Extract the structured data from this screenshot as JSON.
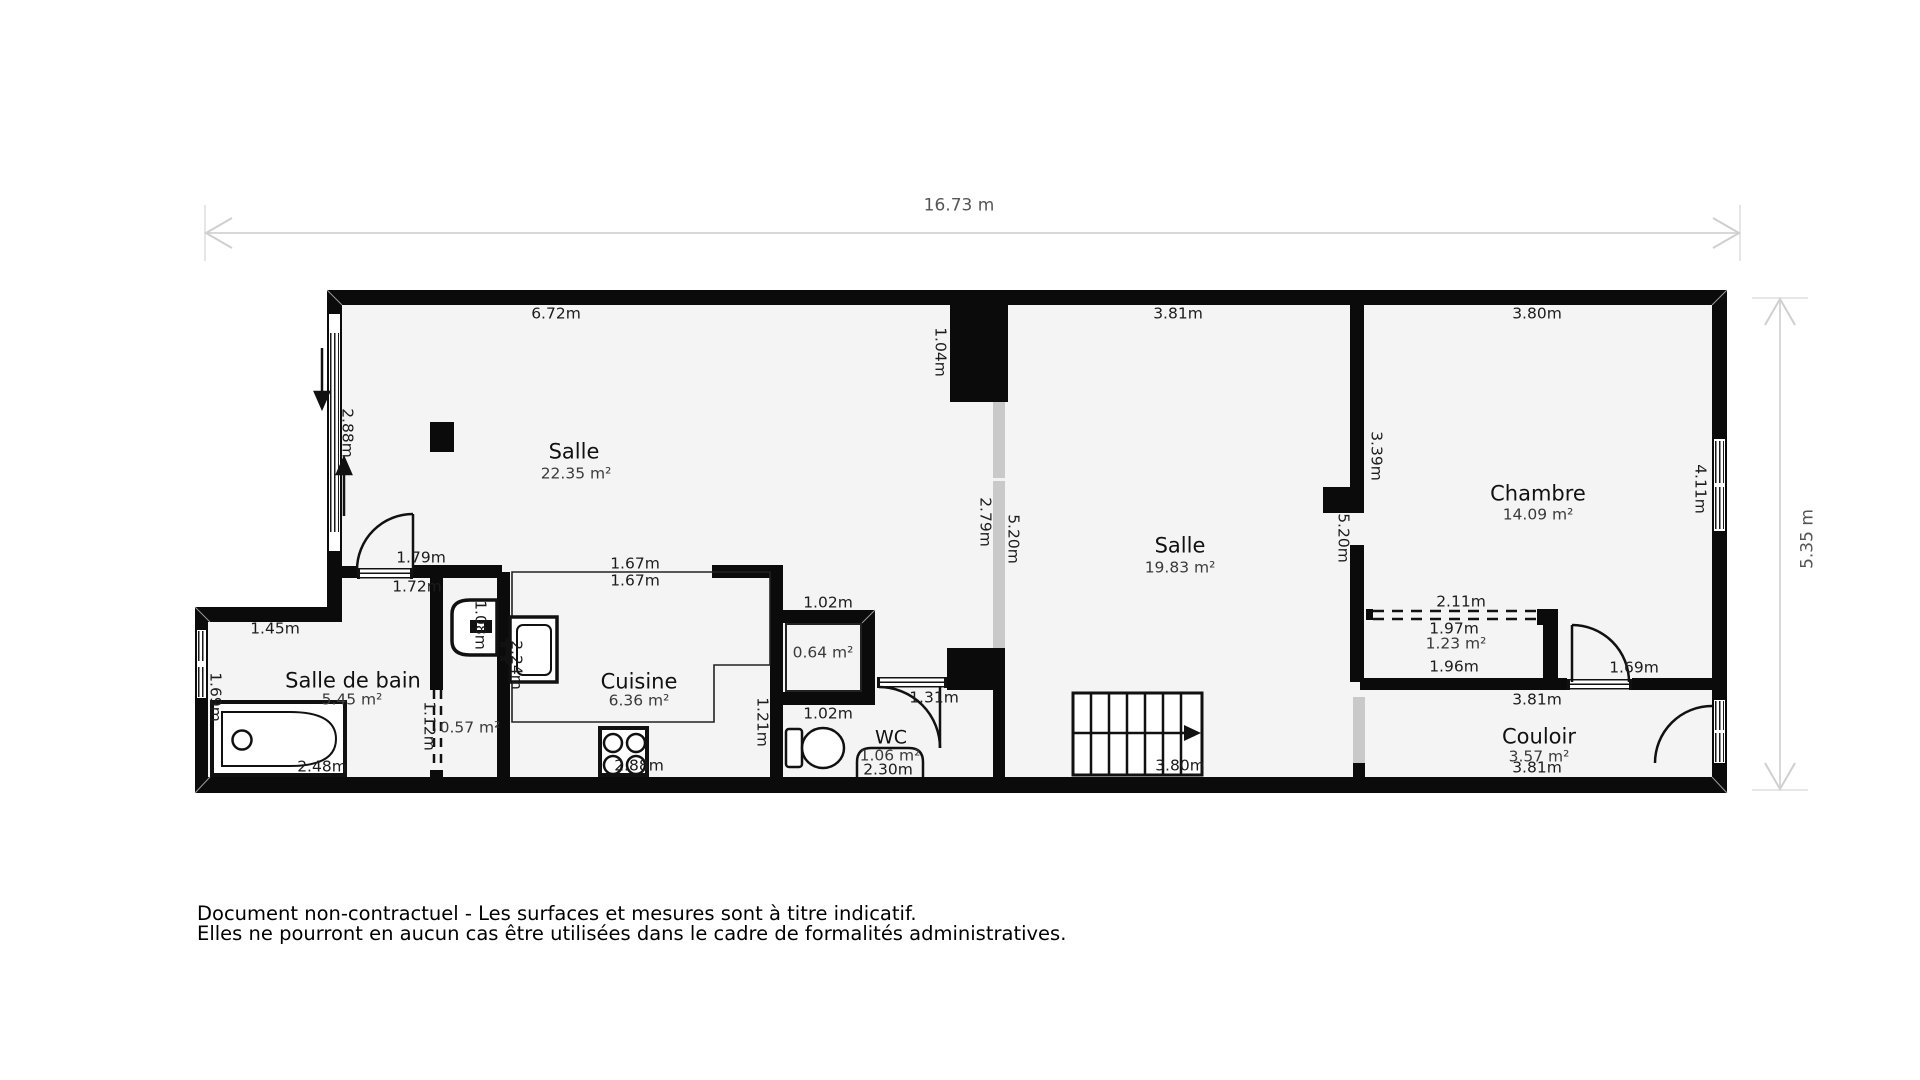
{
  "document": {
    "type": "floor-plan",
    "disclaimer_line1": "Document non-contractuel - Les surfaces et mesures sont à titre indicatif.",
    "disclaimer_line2": "Elles ne pourront en aucun cas être utilisées dans le cadre de formalités administratives.",
    "total_width": "16.73 m",
    "total_height": "5.35 m"
  },
  "rooms": [
    {
      "name": "Salle",
      "area": "22.35 m²"
    },
    {
      "name": "Salle",
      "area": "19.83 m²"
    },
    {
      "name": "Chambre",
      "area": "14.09 m²"
    },
    {
      "name": "Salle de bain",
      "area": "5.45 m²"
    },
    {
      "name": "Cuisine",
      "area": "6.36 m²"
    },
    {
      "name": "WC",
      "area": "1.06 m²"
    },
    {
      "name": "Couloir",
      "area": "3.57 m²"
    },
    {
      "name": "placard-chambre",
      "area": "1.23 m²"
    },
    {
      "name": "placard-cuisine",
      "area": "0.64 m²"
    },
    {
      "name": "placard-sdb",
      "area": "0.57 m²"
    }
  ],
  "labels": [
    {
      "name": "dim-total-width",
      "text": "16.73 m",
      "x": 959,
      "y": 206,
      "cls": "dim-total"
    },
    {
      "name": "dim-total-height",
      "text": "5.35 m",
      "x": 1808,
      "y": 539,
      "cls": "dim-total rot"
    },
    {
      "name": "dim-salle1-top",
      "text": "6.72m",
      "x": 556,
      "y": 314,
      "cls": "dim"
    },
    {
      "name": "dim-salle2-top",
      "text": "3.81m",
      "x": 1178,
      "y": 314,
      "cls": "dim"
    },
    {
      "name": "dim-chambre-top",
      "text": "3.80m",
      "x": 1537,
      "y": 314,
      "cls": "dim"
    },
    {
      "name": "room-salle1-name",
      "text": "Salle",
      "x": 574,
      "y": 452,
      "cls": "room-name"
    },
    {
      "name": "room-salle1-area",
      "text": "22.35 m²",
      "x": 576,
      "y": 474,
      "cls": "room-area"
    },
    {
      "name": "dim-pillar",
      "text": "1.04m",
      "x": 940,
      "y": 352,
      "cls": "dim dim-v"
    },
    {
      "name": "dim-salle1-window",
      "text": "2.88m",
      "x": 347,
      "y": 433,
      "cls": "dim dim-v"
    },
    {
      "name": "dim-chambre-left",
      "text": "3.39m",
      "x": 1376,
      "y": 456,
      "cls": "dim dim-v"
    },
    {
      "name": "dim-chambre-right",
      "text": "4.11m",
      "x": 1700,
      "y": 489,
      "cls": "dim dim-v"
    },
    {
      "name": "dim-glazing",
      "text": "2.79m",
      "x": 985,
      "y": 522,
      "cls": "dim dim-v"
    },
    {
      "name": "dim-salle2-left",
      "text": "5.20m",
      "x": 1013,
      "y": 539,
      "cls": "dim dim-v"
    },
    {
      "name": "dim-salle2-right",
      "text": "5.20m",
      "x": 1343,
      "y": 538,
      "cls": "dim dim-v"
    },
    {
      "name": "room-salle2-name",
      "text": "Salle",
      "x": 1180,
      "y": 546,
      "cls": "room-name"
    },
    {
      "name": "room-salle2-area",
      "text": "19.83 m²",
      "x": 1180,
      "y": 568,
      "cls": "room-area"
    },
    {
      "name": "room-chambre-name",
      "text": "Chambre",
      "x": 1538,
      "y": 494,
      "cls": "room-name"
    },
    {
      "name": "room-chambre-area",
      "text": "14.09 m²",
      "x": 1538,
      "y": 515,
      "cls": "room-area"
    },
    {
      "name": "dim-door-entree-top",
      "text": "1.79m",
      "x": 421,
      "y": 558,
      "cls": "dim"
    },
    {
      "name": "dim-door-entree-bottom",
      "text": "1.72m",
      "x": 417,
      "y": 587,
      "cls": "dim"
    },
    {
      "name": "dim-cuisine-open-top",
      "text": "1.67m",
      "x": 635,
      "y": 564,
      "cls": "dim"
    },
    {
      "name": "dim-cuisine-open-bottom",
      "text": "1.67m",
      "x": 635,
      "y": 581,
      "cls": "dim"
    },
    {
      "name": "dim-placard-cuisine-top",
      "text": "1.02m",
      "x": 828,
      "y": 603,
      "cls": "dim"
    },
    {
      "name": "area-placard-cuisine",
      "text": "0.64 m²",
      "x": 823,
      "y": 653,
      "cls": "room-area"
    },
    {
      "name": "dim-placard-cuisine-bottom",
      "text": "1.02m",
      "x": 828,
      "y": 714,
      "cls": "dim"
    },
    {
      "name": "dim-sdb-top",
      "text": "1.45m",
      "x": 275,
      "y": 629,
      "cls": "dim"
    },
    {
      "name": "room-sdb-name",
      "text": "Salle de bain",
      "x": 353,
      "y": 681,
      "cls": "room-name"
    },
    {
      "name": "room-sdb-area",
      "text": "5.45 m²",
      "x": 352,
      "y": 700,
      "cls": "room-area"
    },
    {
      "name": "dim-sdb-window",
      "text": "1.69m",
      "x": 215,
      "y": 697,
      "cls": "dim dim-v"
    },
    {
      "name": "dim-bathtub",
      "text": "2.48m",
      "x": 322,
      "y": 767,
      "cls": "dim"
    },
    {
      "name": "dim-basin-zone",
      "text": "1.08m",
      "x": 480,
      "y": 625,
      "cls": "dim dim-v"
    },
    {
      "name": "dim-cuisine-left",
      "text": "2.24m",
      "x": 516,
      "y": 665,
      "cls": "dim dim-v"
    },
    {
      "name": "dim-placard-sdb",
      "text": "1.12m",
      "x": 429,
      "y": 726,
      "cls": "dim dim-v"
    },
    {
      "name": "area-placard-sdb",
      "text": "0.57 m²",
      "x": 470,
      "y": 728,
      "cls": "room-area"
    },
    {
      "name": "room-cuisine-name",
      "text": "Cuisine",
      "x": 639,
      "y": 682,
      "cls": "room-name"
    },
    {
      "name": "room-cuisine-area",
      "text": "6.36 m²",
      "x": 639,
      "y": 701,
      "cls": "room-area"
    },
    {
      "name": "dim-cuisine-bottom",
      "text": "2.88m",
      "x": 639,
      "y": 766,
      "cls": "dim"
    },
    {
      "name": "dim-cuisine-right",
      "text": "1.21m",
      "x": 762,
      "y": 722,
      "cls": "dim dim-v"
    },
    {
      "name": "room-wc-name",
      "text": "WC",
      "x": 891,
      "y": 738,
      "cls": "room-name wc"
    },
    {
      "name": "room-wc-area",
      "text": "1.06 m²",
      "x": 890,
      "y": 756,
      "cls": "room-area"
    },
    {
      "name": "dim-wc",
      "text": "2.30m",
      "x": 888,
      "y": 770,
      "cls": "dim"
    },
    {
      "name": "dim-wc-door",
      "text": "1.31m",
      "x": 934,
      "y": 698,
      "cls": "dim"
    },
    {
      "name": "dim-stairs",
      "text": "3.80m",
      "x": 1180,
      "y": 766,
      "cls": "dim"
    },
    {
      "name": "dim-placard-chambre-top",
      "text": "2.11m",
      "x": 1461,
      "y": 602,
      "cls": "dim"
    },
    {
      "name": "dim-placard-chambre-width",
      "text": "1.97m",
      "x": 1454,
      "y": 629,
      "cls": "dim"
    },
    {
      "name": "area-placard-chambre",
      "text": "1.23 m²",
      "x": 1456,
      "y": 644,
      "cls": "room-area"
    },
    {
      "name": "dim-placard-chambre-bottom",
      "text": "1.96m",
      "x": 1454,
      "y": 667,
      "cls": "dim"
    },
    {
      "name": "dim-chambre-door",
      "text": "1.69m",
      "x": 1634,
      "y": 668,
      "cls": "dim"
    },
    {
      "name": "dim-couloir-top",
      "text": "3.81m",
      "x": 1537,
      "y": 700,
      "cls": "dim"
    },
    {
      "name": "room-couloir-name",
      "text": "Couloir",
      "x": 1539,
      "y": 737,
      "cls": "room-name"
    },
    {
      "name": "room-couloir-area",
      "text": "3.57 m²",
      "x": 1539,
      "y": 757,
      "cls": "room-area"
    },
    {
      "name": "dim-couloir-bottom",
      "text": "3.81m",
      "x": 1537,
      "y": 768,
      "cls": "dim"
    }
  ]
}
